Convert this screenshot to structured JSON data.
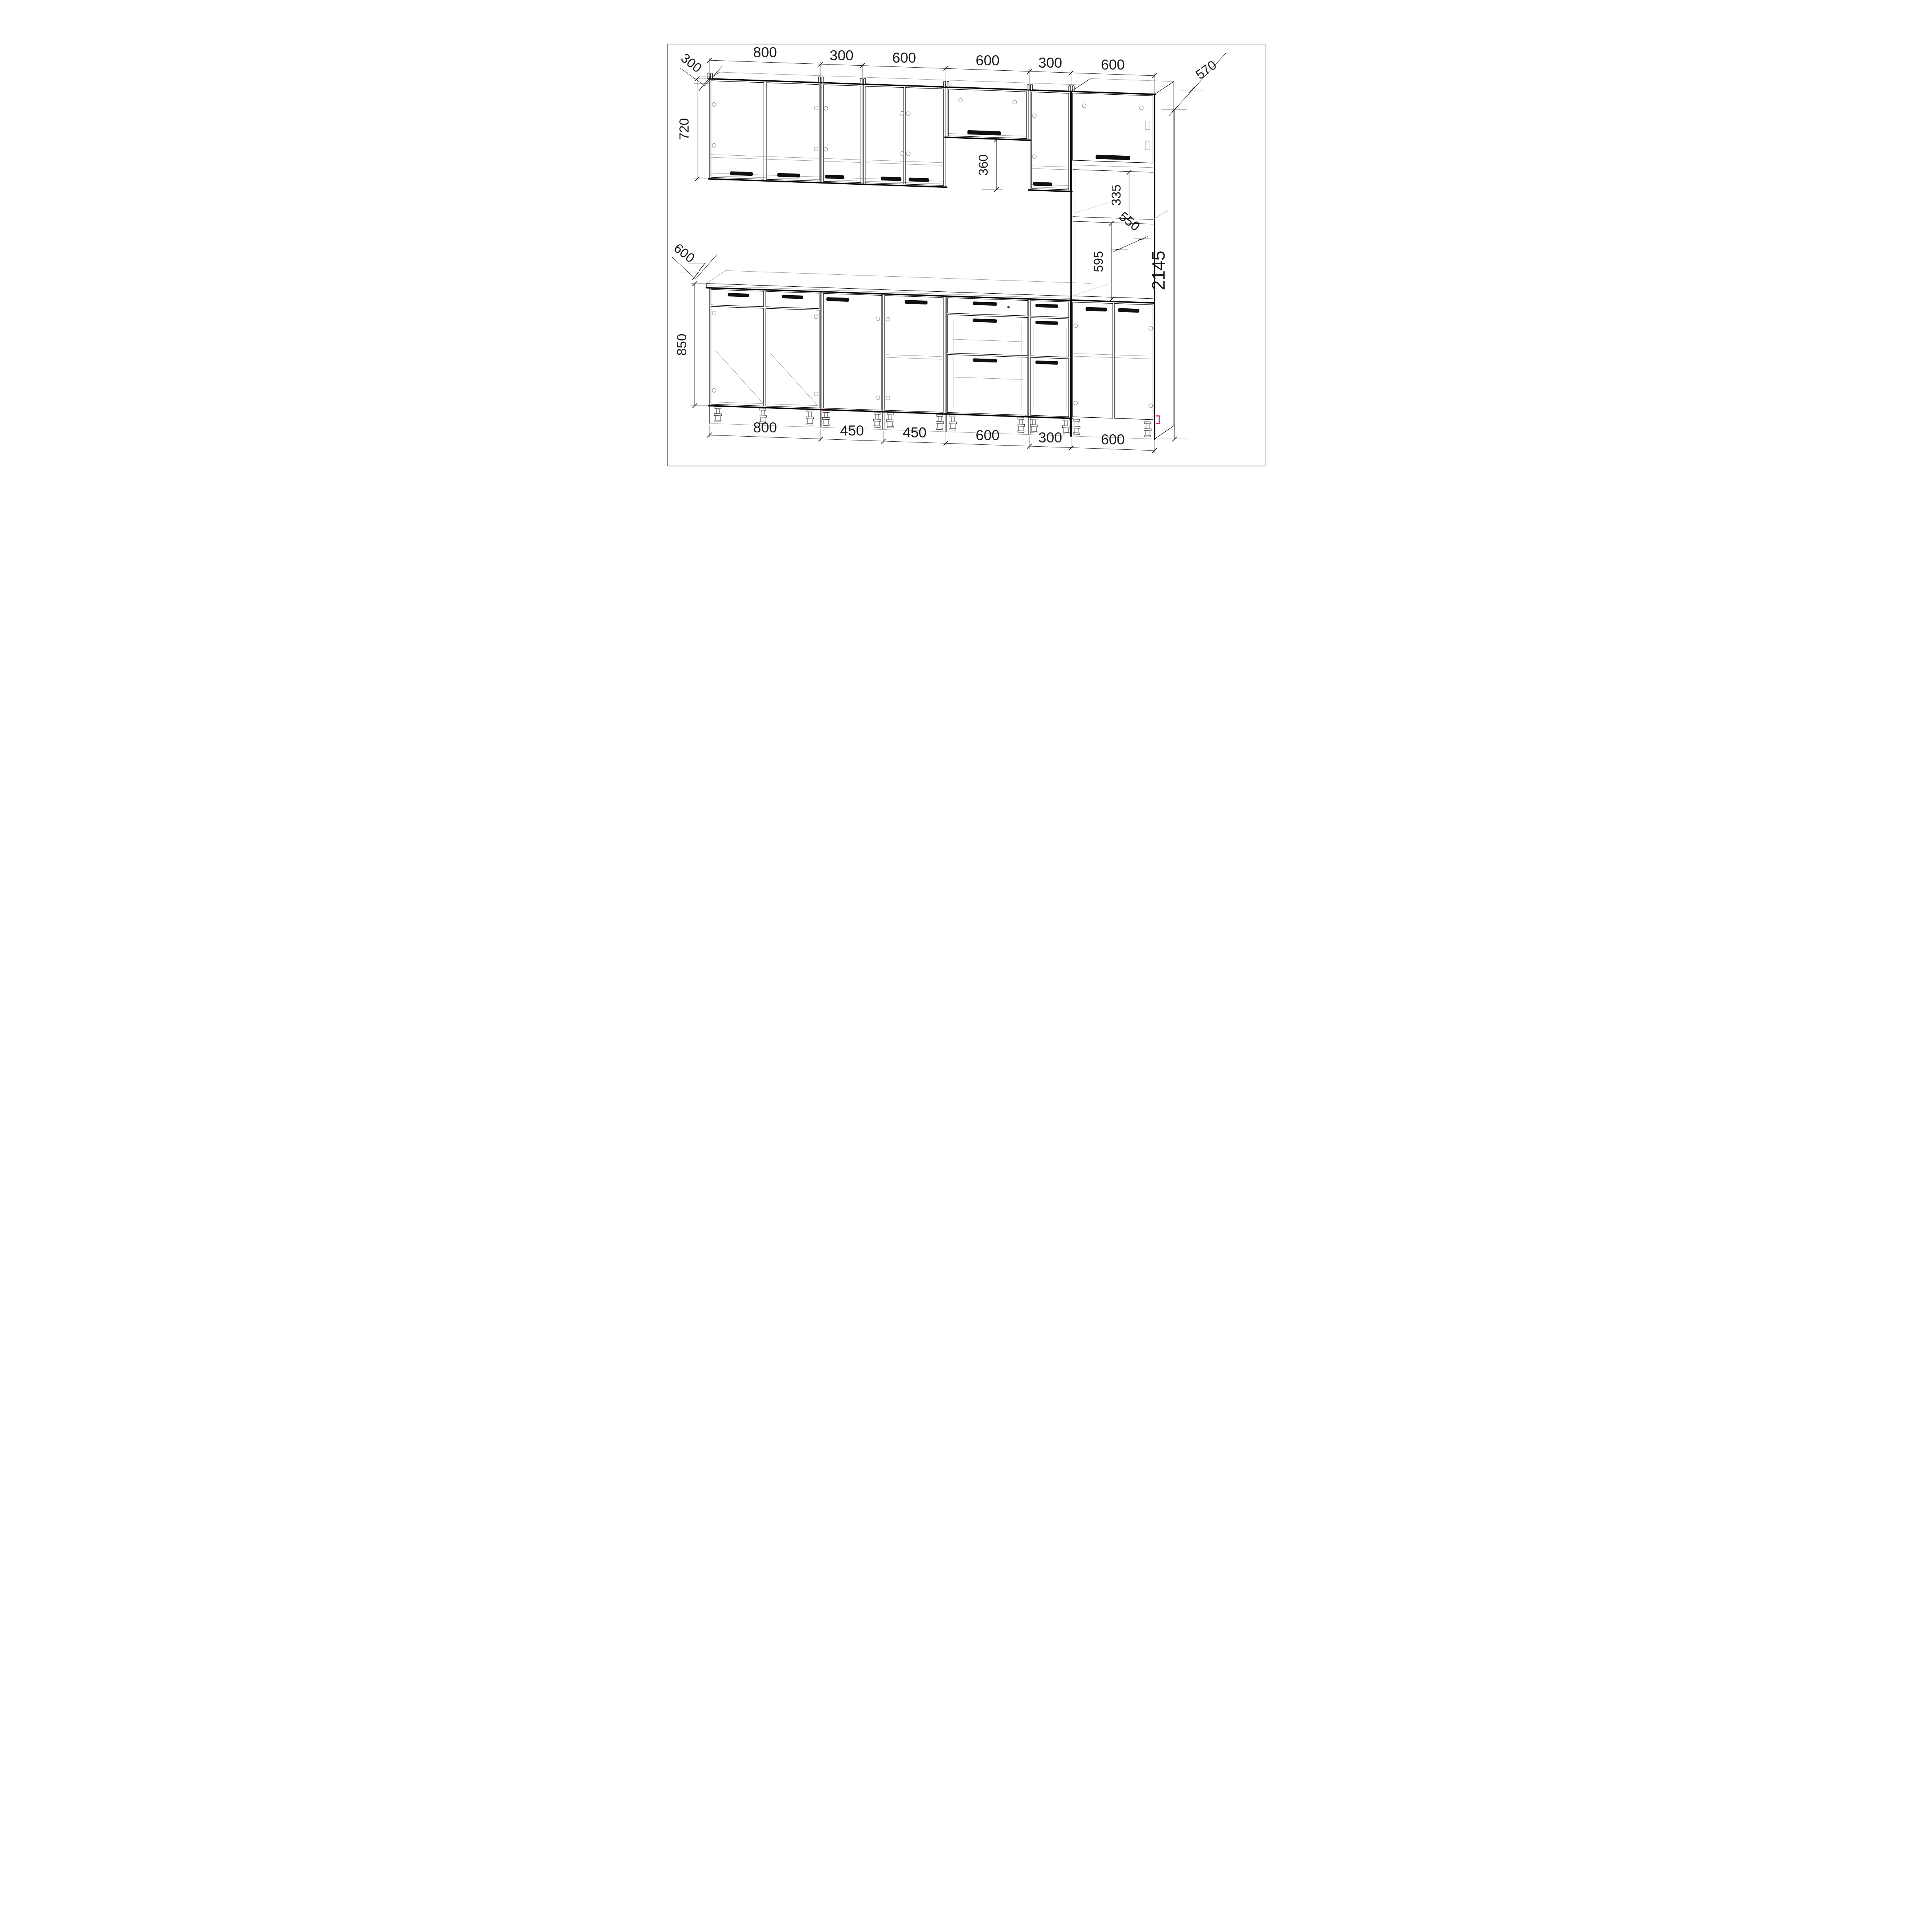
{
  "drawing": {
    "title": "kitchen-cabinet-assembly-drawing",
    "units": "mm",
    "background_color": "#ffffff",
    "line_color": "#000000",
    "accent_color": "#e5007e"
  },
  "dims": {
    "top": [
      "800",
      "300",
      "600",
      "600",
      "300",
      "600"
    ],
    "bottom": [
      "800",
      "450",
      "450",
      "600",
      "300",
      "600"
    ],
    "left": {
      "wall_depth": "300",
      "wall_height": "720",
      "base_depth": "600",
      "base_height": "850"
    },
    "mid": {
      "hood_height": "360",
      "inner_depth": "550"
    },
    "right": {
      "tall_depth": "570",
      "opening_height": "335",
      "oven_niche_height": "595",
      "total_height": "2145"
    }
  }
}
